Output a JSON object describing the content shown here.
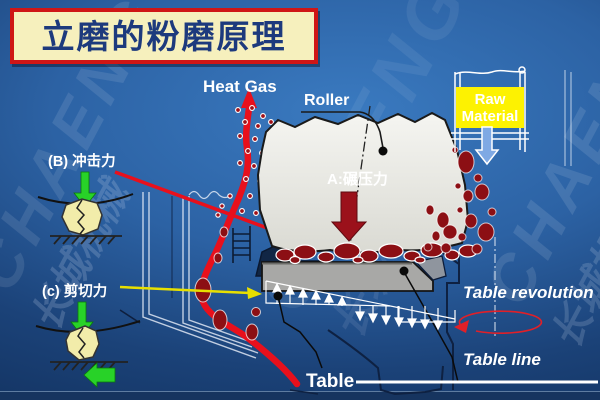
{
  "title": {
    "text": "立磨的粉磨原理"
  },
  "watermark": {
    "brand": "CHAENG",
    "brand_cn": "长城机械"
  },
  "labels": {
    "heat_gas": "Heat Gas",
    "roller": "Roller",
    "raw_material_line1": "Raw",
    "raw_material_line2": "Material",
    "force_a": "A:碾压力",
    "force_b": "(B) 冲击力",
    "force_c": "(c) 剪切力",
    "table_revolution": "Table revolution",
    "table_line": "Table line",
    "table": "Table"
  },
  "colors": {
    "background_center": "#3a7ac0",
    "background_edge": "#102e5a",
    "banner_background": "#f6f0bd",
    "banner_border": "#cf1616",
    "banner_text": "#1d3a7d",
    "accent_red": "#e8101c",
    "particle_dark_red": "#8c0f14",
    "force_a_text": "#b01020",
    "raw_box_yellow": "#fdf201",
    "raw_box_text": "#8b0000",
    "green_arrow": "#28d228",
    "yellow_pointer": "#e8e000",
    "table_gray": "#a8a8a6",
    "rock_yellow": "#f2ecaa",
    "label_white": "#ffffff"
  }
}
